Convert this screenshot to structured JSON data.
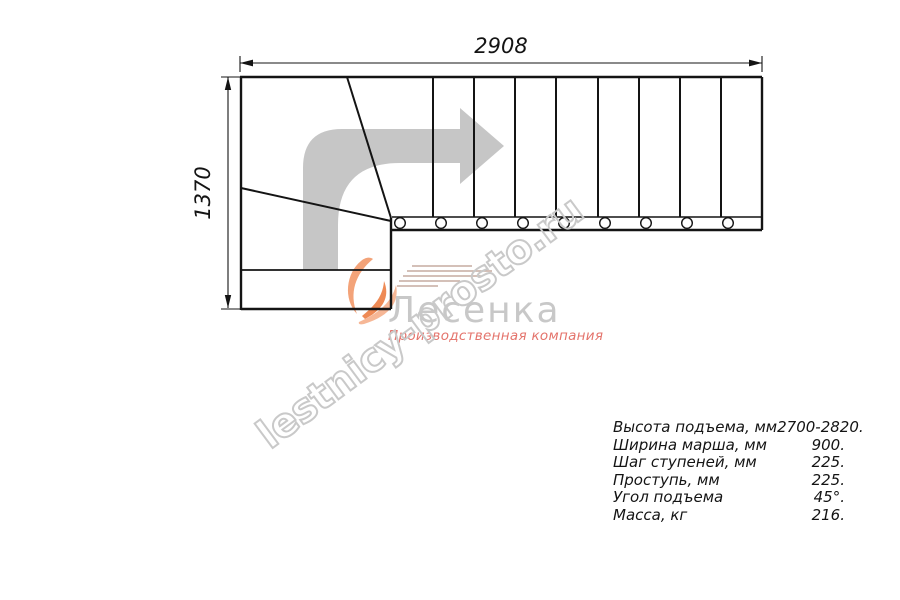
{
  "drawing": {
    "dim_top": "2908",
    "dim_left": "1370"
  },
  "watermark": {
    "text": "lestnicy-prosto.ru"
  },
  "logo": {
    "name": "Лесенка",
    "tagline": "Производственная компания"
  },
  "specs": {
    "rows": [
      {
        "label": "Высота подъема, мм",
        "value": "2700-2820."
      },
      {
        "label": "Ширина марша, мм",
        "value": "900."
      },
      {
        "label": "Шаг ступеней, мм",
        "value": "225."
      },
      {
        "label": "Проступь, мм",
        "value": "225."
      },
      {
        "label": "Угол подъема",
        "value": "45°."
      },
      {
        "label": "Масса, кг",
        "value": "216."
      }
    ]
  },
  "colors": {
    "line": "#141414",
    "arrow_gray": "#c6c6c6",
    "watermark_gray": "#c9c9c9",
    "logo_gray": "#c8c8c8",
    "logo_orange": "#ef8a52",
    "logo_salmon": "#e4746c"
  }
}
